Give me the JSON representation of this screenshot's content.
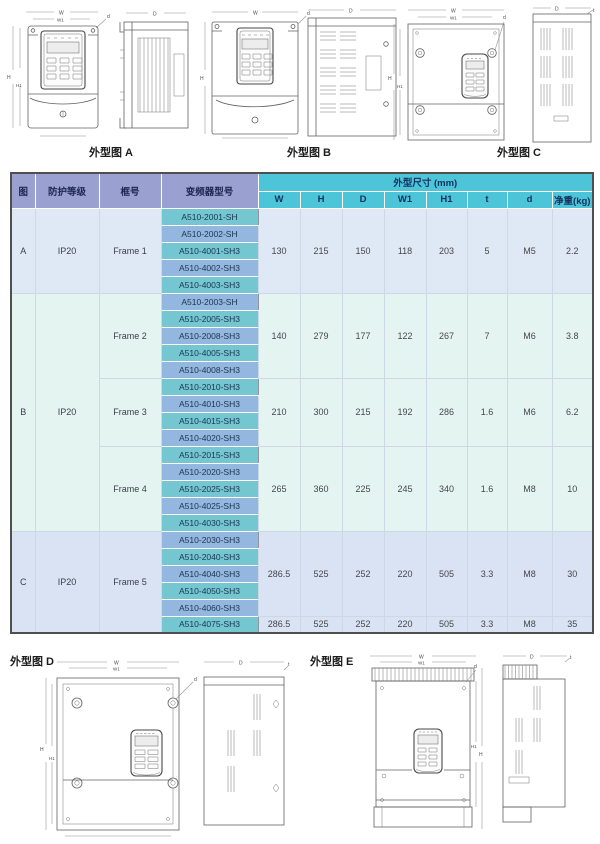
{
  "page": {
    "background": "#ffffff"
  },
  "figures": {
    "top": [
      {
        "label": "外型图 A"
      },
      {
        "label": "外型图 B"
      },
      {
        "label": "外型图 C"
      }
    ],
    "bottom": [
      {
        "label": "外型图 D"
      },
      {
        "label": "外型图 E"
      }
    ]
  },
  "dims": {
    "w": "W",
    "w1": "W1",
    "h": "H",
    "h1": "H1",
    "depth": "D",
    "thickness": "t",
    "hole": "d"
  },
  "table": {
    "header": {
      "fig": "图",
      "protection": "防护等级",
      "frame": "框号",
      "model": "变频器型号",
      "dims_group": "外型尺寸 (mm)",
      "dims": [
        "W",
        "H",
        "D",
        "W1",
        "H1",
        "t",
        "d",
        "净重(kg)"
      ]
    },
    "groups": [
      {
        "fig": "A",
        "protection": "IP20",
        "frames": [
          {
            "name": "Frame 1",
            "models": [
              "A510-2001-SH",
              "A510-2002-SH",
              "A510-4001-SH3",
              "A510-4002-SH3",
              "A510-4003-SH3"
            ],
            "dims": [
              "130",
              "215",
              "150",
              "118",
              "203",
              "5",
              "M5",
              "2.2"
            ]
          }
        ]
      },
      {
        "fig": "B",
        "protection": "IP20",
        "frames": [
          {
            "name": "Frame 2",
            "models": [
              "A510-2003-SH",
              "A510-2005-SH3",
              "A510-2008-SH3",
              "A510-4005-SH3",
              "A510-4008-SH3"
            ],
            "dims": [
              "140",
              "279",
              "177",
              "122",
              "267",
              "7",
              "M6",
              "3.8"
            ]
          },
          {
            "name": "Frame 3",
            "models": [
              "A510-2010-SH3",
              "A510-4010-SH3",
              "A510-4015-SH3",
              "A510-4020-SH3"
            ],
            "dims": [
              "210",
              "300",
              "215",
              "192",
              "286",
              "1.6",
              "M6",
              "6.2"
            ]
          },
          {
            "name": "Frame 4",
            "models": [
              "A510-2015-SH3",
              "A510-2020-SH3",
              "A510-2025-SH3",
              "A510-4025-SH3",
              "A510-4030-SH3"
            ],
            "dims": [
              "265",
              "360",
              "225",
              "245",
              "340",
              "1.6",
              "M8",
              "10"
            ]
          }
        ]
      },
      {
        "fig": "C",
        "protection": "IP20",
        "frames": [
          {
            "name": "Frame 5",
            "models": [
              "A510-2030-SH3",
              "A510-2040-SH3",
              "A510-4040-SH3",
              "A510-4050-SH3",
              "A510-4060-SH3",
              "A510-4075-SH3"
            ],
            "dims": [
              "286.5",
              "525",
              "252",
              "220",
              "505",
              "3.3",
              "M8",
              "30"
            ],
            "dims_row6": [
              "286.5",
              "525",
              "252",
              "220",
              "505",
              "3.3",
              "M8",
              "35"
            ]
          }
        ]
      }
    ],
    "colors": {
      "header_purple": "#9aa0d0",
      "header_teal": "#4cc5d8",
      "model_teal": "#74c7d1",
      "model_blue": "#93b7de",
      "section_a_bg": "#dfe9f5",
      "section_b_bg": "#e4f4f1",
      "section_c_bg": "#d9e3f3"
    }
  }
}
